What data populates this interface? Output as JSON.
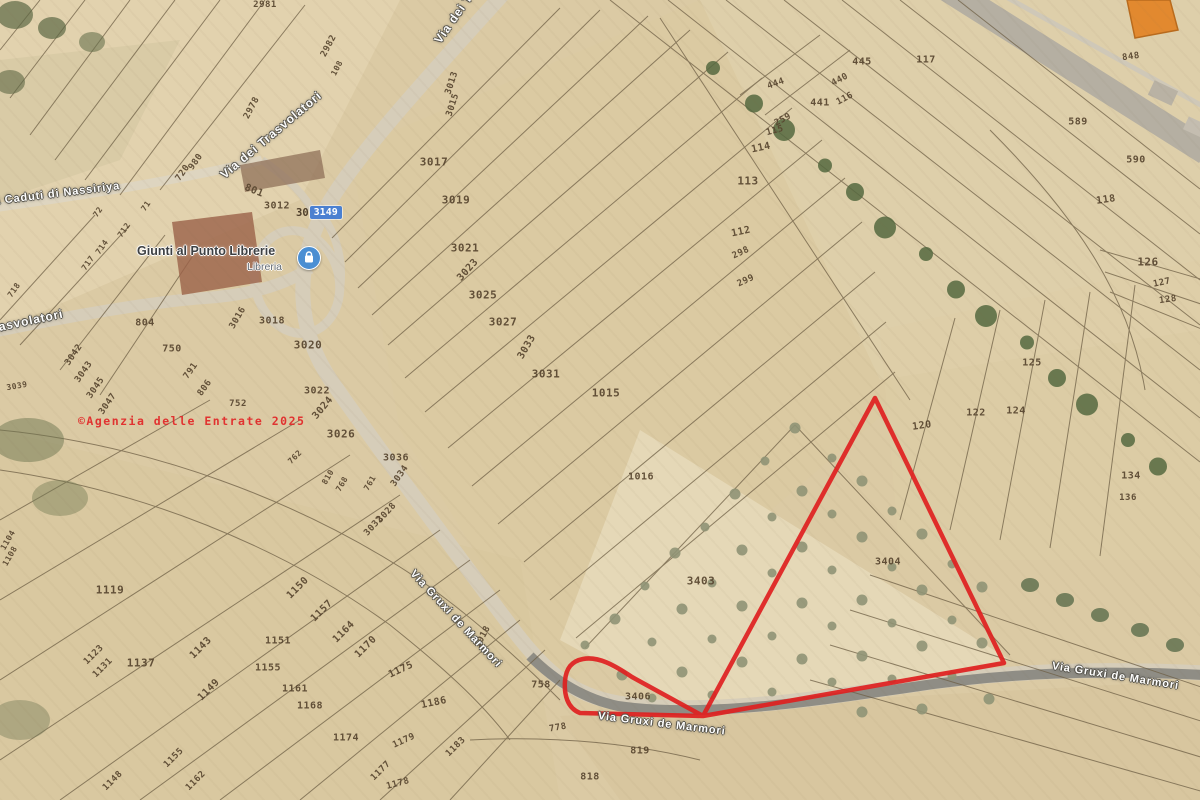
{
  "map": {
    "watermark": "©Agenzia delle Entrate 2025",
    "colors": {
      "highlight_red": "#e01f1f",
      "watermark_red": "#e22a2a",
      "selection_blue": "#4a80d2",
      "poi_blue": "#4a8fd4",
      "parcel_label_brown": "#57452f",
      "road_fill": "#d6cdb9",
      "asphalt": "#8f8d85",
      "field_base": "#dbcaa4"
    },
    "poi": {
      "name": "Giunti al Punto Librerie",
      "category": "Libreria"
    },
    "selected_parcel": {
      "prefix": "30",
      "number": "3149"
    },
    "road_labels": [
      {
        "t": "Via dei Trasvolatori",
        "x": 222,
        "y": 176,
        "r": -40,
        "s": 12
      },
      {
        "t": "Via dei Trasvolatori",
        "x": 437,
        "y": 42,
        "r": -55,
        "s": 12
      },
      {
        "t": "Via Caduti di Nassiriya",
        "x": -18,
        "y": 203,
        "r": -7,
        "s": 11
      },
      {
        "t": "Via dei Trasvolatori",
        "x": -62,
        "y": 340,
        "r": -12,
        "s": 12
      },
      {
        "t": "Via Gruxi de Marmori",
        "x": 412,
        "y": 572,
        "r": 47,
        "s": 11
      },
      {
        "t": "Via Gruxi de Marmori",
        "x": 598,
        "y": 716,
        "r": 7,
        "s": 11
      },
      {
        "t": "Via Gruxi de Marmori",
        "x": 1052,
        "y": 666,
        "r": 9,
        "s": 11
      }
    ],
    "parcel_labels": [
      {
        "t": "2981",
        "x": 265,
        "y": 5,
        "r": 0,
        "s": 9
      },
      {
        "t": "2982",
        "x": 329,
        "y": 46,
        "r": -62,
        "s": 9
      },
      {
        "t": "108",
        "x": 337,
        "y": 68,
        "r": -62,
        "s": 8
      },
      {
        "t": "2978",
        "x": 252,
        "y": 108,
        "r": -62,
        "s": 9
      },
      {
        "t": "980",
        "x": 196,
        "y": 162,
        "r": -55,
        "s": 9
      },
      {
        "t": "720",
        "x": 183,
        "y": 173,
        "r": -55,
        "s": 9
      },
      {
        "t": "801",
        "x": 254,
        "y": 191,
        "r": 22,
        "s": 10
      },
      {
        "t": "3012",
        "x": 277,
        "y": 206,
        "r": 0,
        "s": 10
      },
      {
        "t": "3013",
        "x": 452,
        "y": 83,
        "r": -72,
        "s": 9
      },
      {
        "t": "3015",
        "x": 453,
        "y": 105,
        "r": -72,
        "s": 9
      },
      {
        "t": "3017",
        "x": 434,
        "y": 162,
        "r": 0,
        "s": 11
      },
      {
        "t": "3019",
        "x": 456,
        "y": 200,
        "r": 0,
        "s": 11
      },
      {
        "t": "3021",
        "x": 465,
        "y": 248,
        "r": 0,
        "s": 11
      },
      {
        "t": "3023",
        "x": 468,
        "y": 270,
        "r": -48,
        "s": 10
      },
      {
        "t": "3025",
        "x": 483,
        "y": 295,
        "r": 0,
        "s": 11
      },
      {
        "t": "3027",
        "x": 503,
        "y": 322,
        "r": 0,
        "s": 11
      },
      {
        "t": "3033",
        "x": 527,
        "y": 347,
        "r": -60,
        "s": 10
      },
      {
        "t": "3031",
        "x": 546,
        "y": 374,
        "r": 0,
        "s": 11
      },
      {
        "t": "1015",
        "x": 606,
        "y": 393,
        "r": 0,
        "s": 11
      },
      {
        "t": "1016",
        "x": 641,
        "y": 477,
        "r": 0,
        "s": 10
      },
      {
        "t": "72",
        "x": 98,
        "y": 212,
        "r": -55,
        "s": 8
      },
      {
        "t": "71",
        "x": 146,
        "y": 206,
        "r": -55,
        "s": 8
      },
      {
        "t": "712",
        "x": 124,
        "y": 230,
        "r": -55,
        "s": 8
      },
      {
        "t": "714",
        "x": 102,
        "y": 247,
        "r": -55,
        "s": 8
      },
      {
        "t": "717",
        "x": 88,
        "y": 263,
        "r": -55,
        "s": 8
      },
      {
        "t": "718",
        "x": 14,
        "y": 290,
        "r": -55,
        "s": 8
      },
      {
        "t": "3042",
        "x": 74,
        "y": 355,
        "r": -55,
        "s": 9
      },
      {
        "t": "3043",
        "x": 84,
        "y": 372,
        "r": -55,
        "s": 9
      },
      {
        "t": "3045",
        "x": 96,
        "y": 388,
        "r": -55,
        "s": 9
      },
      {
        "t": "3047",
        "x": 108,
        "y": 404,
        "r": -55,
        "s": 9
      },
      {
        "t": "3039",
        "x": 17,
        "y": 386,
        "r": -10,
        "s": 8
      },
      {
        "t": "804",
        "x": 145,
        "y": 323,
        "r": 0,
        "s": 10
      },
      {
        "t": "750",
        "x": 172,
        "y": 349,
        "r": 0,
        "s": 10
      },
      {
        "t": "791",
        "x": 191,
        "y": 371,
        "r": -55,
        "s": 9
      },
      {
        "t": "806",
        "x": 205,
        "y": 388,
        "r": -55,
        "s": 9
      },
      {
        "t": "752",
        "x": 238,
        "y": 404,
        "r": 0,
        "s": 9
      },
      {
        "t": "3016",
        "x": 238,
        "y": 318,
        "r": -60,
        "s": 9
      },
      {
        "t": "3018",
        "x": 272,
        "y": 321,
        "r": 0,
        "s": 10
      },
      {
        "t": "3020",
        "x": 308,
        "y": 345,
        "r": 0,
        "s": 11
      },
      {
        "t": "3022",
        "x": 317,
        "y": 391,
        "r": 0,
        "s": 10
      },
      {
        "t": "3024",
        "x": 323,
        "y": 408,
        "r": -50,
        "s": 10
      },
      {
        "t": "3026",
        "x": 341,
        "y": 434,
        "r": 0,
        "s": 11
      },
      {
        "t": "3036",
        "x": 396,
        "y": 458,
        "r": 0,
        "s": 10
      },
      {
        "t": "3034",
        "x": 400,
        "y": 476,
        "r": -55,
        "s": 9
      },
      {
        "t": "762",
        "x": 295,
        "y": 457,
        "r": -45,
        "s": 8
      },
      {
        "t": "810",
        "x": 328,
        "y": 477,
        "r": -60,
        "s": 8
      },
      {
        "t": "768",
        "x": 342,
        "y": 484,
        "r": -60,
        "s": 8
      },
      {
        "t": "761",
        "x": 370,
        "y": 483,
        "r": -60,
        "s": 8
      },
      {
        "t": "3028",
        "x": 387,
        "y": 513,
        "r": -48,
        "s": 9
      },
      {
        "t": "3032",
        "x": 374,
        "y": 526,
        "r": -48,
        "s": 9
      },
      {
        "t": "117",
        "x": 926,
        "y": 60,
        "r": 0,
        "s": 10
      },
      {
        "t": "445",
        "x": 862,
        "y": 62,
        "r": 0,
        "s": 10
      },
      {
        "t": "440",
        "x": 840,
        "y": 80,
        "r": -28,
        "s": 9
      },
      {
        "t": "444",
        "x": 776,
        "y": 84,
        "r": -20,
        "s": 9
      },
      {
        "t": "116",
        "x": 845,
        "y": 99,
        "r": -28,
        "s": 9
      },
      {
        "t": "441",
        "x": 820,
        "y": 103,
        "r": 0,
        "s": 10
      },
      {
        "t": "259",
        "x": 783,
        "y": 120,
        "r": -28,
        "s": 9
      },
      {
        "t": "115",
        "x": 775,
        "y": 131,
        "r": -15,
        "s": 9
      },
      {
        "t": "114",
        "x": 761,
        "y": 148,
        "r": -12,
        "s": 10
      },
      {
        "t": "113",
        "x": 748,
        "y": 181,
        "r": 0,
        "s": 11
      },
      {
        "t": "112",
        "x": 741,
        "y": 232,
        "r": -12,
        "s": 10
      },
      {
        "t": "298",
        "x": 741,
        "y": 253,
        "r": -25,
        "s": 9
      },
      {
        "t": "299",
        "x": 746,
        "y": 281,
        "r": -25,
        "s": 9
      },
      {
        "t": "848",
        "x": 1131,
        "y": 57,
        "r": -8,
        "s": 9
      },
      {
        "t": "589",
        "x": 1078,
        "y": 122,
        "r": 0,
        "s": 10
      },
      {
        "t": "590",
        "x": 1136,
        "y": 160,
        "r": 0,
        "s": 10
      },
      {
        "t": "118",
        "x": 1106,
        "y": 200,
        "r": -8,
        "s": 10
      },
      {
        "t": "126",
        "x": 1148,
        "y": 262,
        "r": 0,
        "s": 11
      },
      {
        "t": "127",
        "x": 1162,
        "y": 283,
        "r": -12,
        "s": 9
      },
      {
        "t": "128",
        "x": 1168,
        "y": 300,
        "r": -8,
        "s": 9
      },
      {
        "t": "125",
        "x": 1032,
        "y": 363,
        "r": 0,
        "s": 10
      },
      {
        "t": "122",
        "x": 976,
        "y": 413,
        "r": 0,
        "s": 10
      },
      {
        "t": "124",
        "x": 1016,
        "y": 411,
        "r": 0,
        "s": 10
      },
      {
        "t": "120",
        "x": 922,
        "y": 426,
        "r": -8,
        "s": 10
      },
      {
        "t": "134",
        "x": 1131,
        "y": 476,
        "r": 0,
        "s": 10
      },
      {
        "t": "136",
        "x": 1128,
        "y": 498,
        "r": 0,
        "s": 9
      },
      {
        "t": "3403",
        "x": 701,
        "y": 581,
        "r": 0,
        "s": 11
      },
      {
        "t": "3404",
        "x": 888,
        "y": 562,
        "r": 0,
        "s": 10
      },
      {
        "t": "3406",
        "x": 638,
        "y": 697,
        "r": 0,
        "s": 10
      },
      {
        "t": "819",
        "x": 640,
        "y": 751,
        "r": 0,
        "s": 10
      },
      {
        "t": "818",
        "x": 590,
        "y": 777,
        "r": 0,
        "s": 10
      },
      {
        "t": "1018",
        "x": 483,
        "y": 637,
        "r": -62,
        "s": 9
      },
      {
        "t": "758",
        "x": 541,
        "y": 685,
        "r": 0,
        "s": 10
      },
      {
        "t": "778",
        "x": 558,
        "y": 728,
        "r": -10,
        "s": 9
      },
      {
        "t": "1119",
        "x": 110,
        "y": 590,
        "r": 0,
        "s": 11
      },
      {
        "t": "1123",
        "x": 94,
        "y": 655,
        "r": -45,
        "s": 9
      },
      {
        "t": "1131",
        "x": 103,
        "y": 668,
        "r": -45,
        "s": 9
      },
      {
        "t": "1137",
        "x": 141,
        "y": 663,
        "r": 0,
        "s": 11
      },
      {
        "t": "1143",
        "x": 201,
        "y": 648,
        "r": -45,
        "s": 10
      },
      {
        "t": "1149",
        "x": 209,
        "y": 690,
        "r": -45,
        "s": 10
      },
      {
        "t": "1150",
        "x": 298,
        "y": 588,
        "r": -45,
        "s": 10
      },
      {
        "t": "1157",
        "x": 322,
        "y": 611,
        "r": -45,
        "s": 10
      },
      {
        "t": "1164",
        "x": 344,
        "y": 632,
        "r": -45,
        "s": 10
      },
      {
        "t": "1151",
        "x": 278,
        "y": 641,
        "r": 0,
        "s": 10
      },
      {
        "t": "1155",
        "x": 268,
        "y": 668,
        "r": 0,
        "s": 10
      },
      {
        "t": "1161",
        "x": 295,
        "y": 689,
        "r": 0,
        "s": 10
      },
      {
        "t": "1168",
        "x": 310,
        "y": 706,
        "r": 0,
        "s": 10
      },
      {
        "t": "1170",
        "x": 366,
        "y": 647,
        "r": -45,
        "s": 10
      },
      {
        "t": "1175",
        "x": 401,
        "y": 670,
        "r": -25,
        "s": 10
      },
      {
        "t": "1186",
        "x": 434,
        "y": 703,
        "r": -12,
        "s": 10
      },
      {
        "t": "1174",
        "x": 346,
        "y": 738,
        "r": 0,
        "s": 10
      },
      {
        "t": "1179",
        "x": 404,
        "y": 741,
        "r": -25,
        "s": 9
      },
      {
        "t": "1183",
        "x": 456,
        "y": 747,
        "r": -45,
        "s": 9
      },
      {
        "t": "1177",
        "x": 381,
        "y": 771,
        "r": -45,
        "s": 9
      },
      {
        "t": "1178",
        "x": 398,
        "y": 784,
        "r": -15,
        "s": 9
      },
      {
        "t": "1148",
        "x": 113,
        "y": 781,
        "r": -45,
        "s": 9
      },
      {
        "t": "1155",
        "x": 174,
        "y": 758,
        "r": -45,
        "s": 9
      },
      {
        "t": "1162",
        "x": 196,
        "y": 781,
        "r": -45,
        "s": 9
      },
      {
        "t": "1104",
        "x": 8,
        "y": 540,
        "r": -60,
        "s": 8
      },
      {
        "t": "1108",
        "x": 10,
        "y": 556,
        "r": -60,
        "s": 8
      }
    ]
  }
}
